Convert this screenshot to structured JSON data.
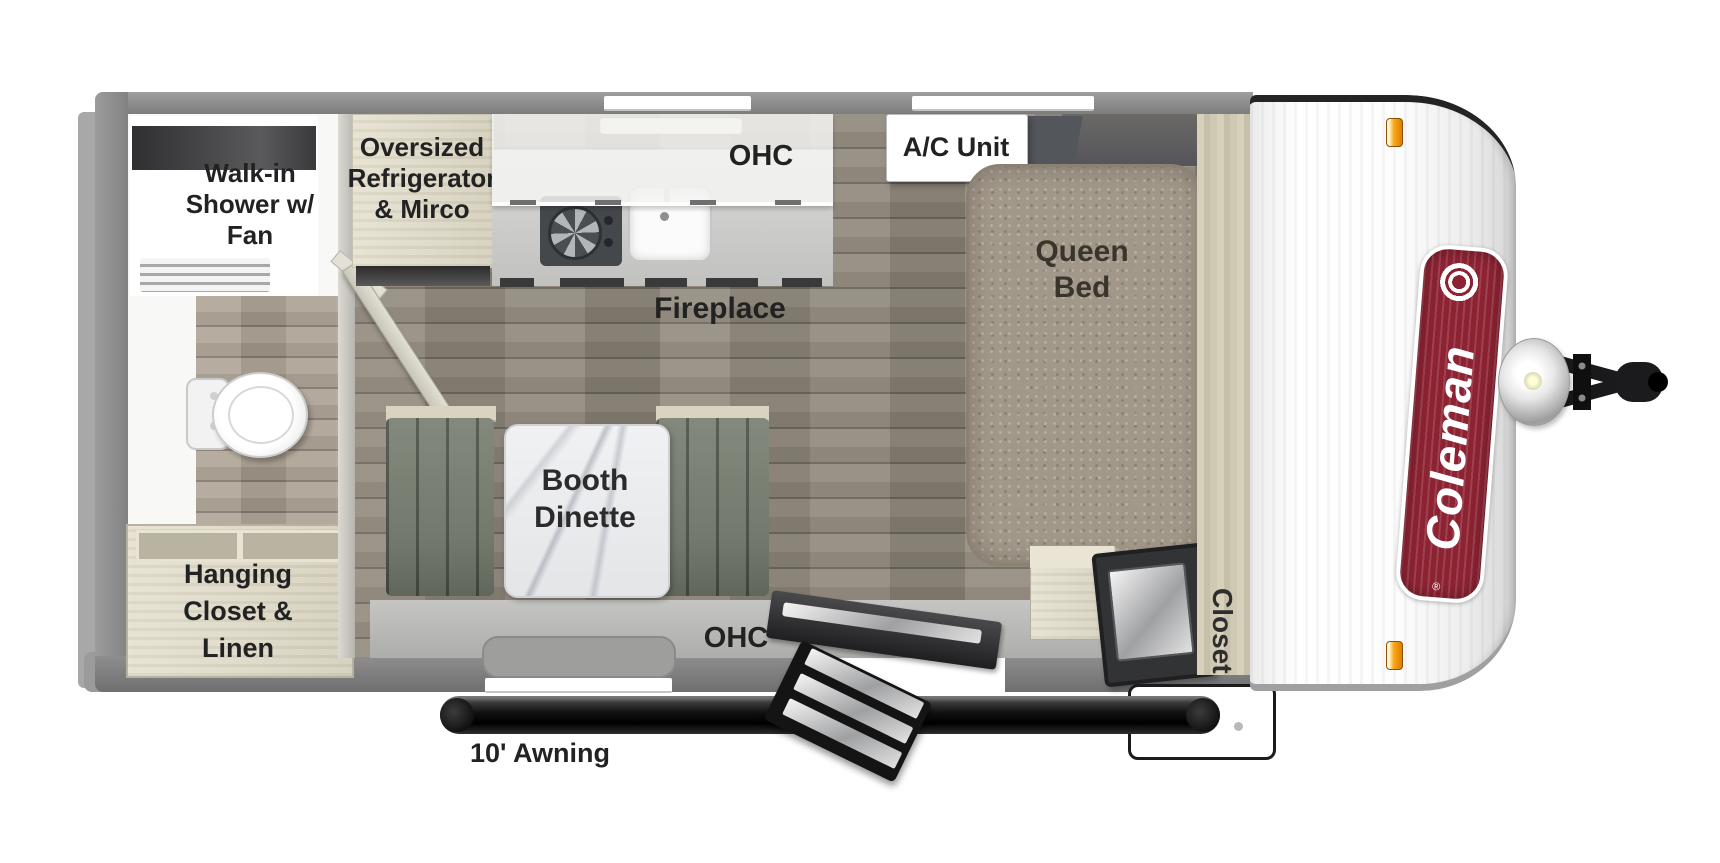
{
  "figure": {
    "type": "travel trailer floor plan",
    "view": "top-down"
  },
  "brand": {
    "name": "Coleman",
    "registered_mark": "®"
  },
  "labels": {
    "shower": [
      "Walk-in",
      "Shower w/",
      "Fan"
    ],
    "refrigerator": [
      "Oversized",
      "Refrigerator",
      "& Mirco"
    ],
    "kitchen_ohc": "OHC",
    "ac_unit": "A/C Unit",
    "queen_bed": [
      "Queen",
      "Bed"
    ],
    "fireplace": "Fireplace",
    "booth_dinette": [
      "Booth",
      "Dinette"
    ],
    "hanging_closet": [
      "Hanging",
      "Closet &",
      "Linen"
    ],
    "dinette_ohc": "OHC",
    "closet": "Closet",
    "awning": "10' Awning"
  },
  "colors": {
    "wall_gray": "#8f8f8f",
    "floor_wood": "#8b8478",
    "cabinet_wood": "#ddd8c6",
    "bed_tan": "#a2988a",
    "bench_green": "#747a6d",
    "coleman_red": "#8c2232",
    "marker_light_orange": "#f7a81b"
  }
}
